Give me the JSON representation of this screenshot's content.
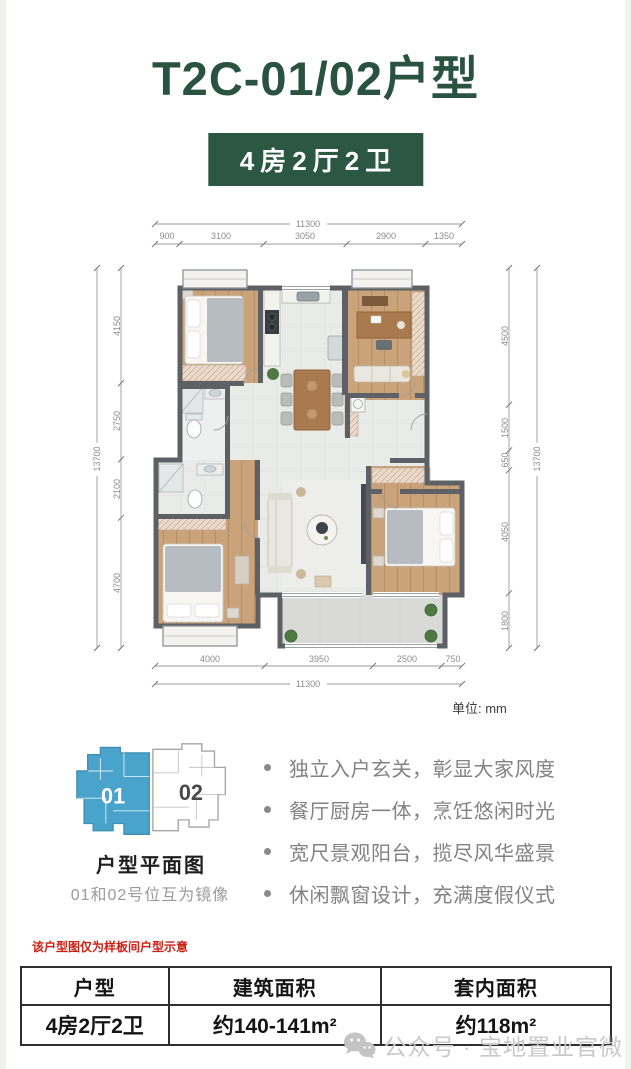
{
  "page": {
    "title": "T2C-01/02户型",
    "badge": "4房2厅2卫"
  },
  "floorplan": {
    "unit_note": "单位: mm",
    "dims": {
      "top_total": "11300",
      "top_segments": [
        "900",
        "3100",
        "3050",
        "2900",
        "1350"
      ],
      "bottom_segments": [
        "4000",
        "3950",
        "2500",
        "750"
      ],
      "bottom_total": "11300",
      "left_total": "13700",
      "left_segments": [
        "4150",
        "2750",
        "2100",
        "4700"
      ],
      "right_segments": [
        "4500",
        "1500",
        "650",
        "4050",
        "1800"
      ],
      "right_total": "13700"
    }
  },
  "locator": {
    "unit01_label": "01",
    "unit02_label": "02",
    "caption": "户型平面图",
    "note": "01和02号位互为镜像",
    "highlight_color": "#4aa3cb"
  },
  "features": {
    "items": [
      "独立入户玄关，彰显大家风度",
      "餐厅厨房一体，烹饪悠闲时光",
      "宽尺景观阳台，揽尽风华盛景",
      "休闲飘窗设计，充满度假仪式"
    ]
  },
  "disclaimer": "该户型图仅为样板间户型示意",
  "table": {
    "headers": [
      "户型",
      "建筑面积",
      "套内面积"
    ],
    "rows": [
      [
        "4房2厅2卫",
        "约140-141m²",
        "约118m²"
      ]
    ]
  },
  "footer": {
    "watermark": "公众号 · 宝地置业官微"
  },
  "colors": {
    "brand_green": "#2a5240",
    "badge_green": "#2c5743",
    "disclaimer_red": "#cc2015",
    "wall_gray": "#5d6165",
    "wood_floor": "#cba37b",
    "locator_blue": "#4aa3cb"
  }
}
